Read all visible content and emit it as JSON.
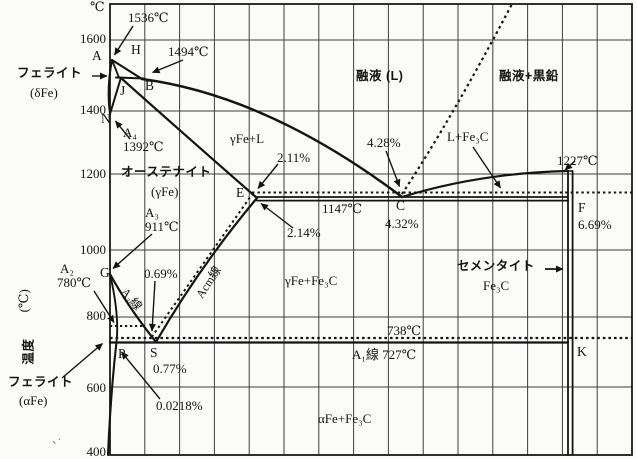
{
  "y_axis": {
    "unit_top": "℃",
    "title_vertical": "温度",
    "title_unit": "(℃)",
    "ticks": [
      "1600",
      "1400",
      "1200",
      "1000",
      "800",
      "600",
      "400"
    ]
  },
  "points": {
    "A": "A",
    "H": "H",
    "B": "B",
    "J": "J",
    "N": "N",
    "E": "E",
    "C": "C",
    "F": "F",
    "G": "G",
    "P": "P",
    "S": "S",
    "K": "K"
  },
  "regions": {
    "ferrite_delta_1": "フェライト",
    "ferrite_delta_2": "(δFe)",
    "austenite_1": "オーステナイト",
    "austenite_2": "(γFe)",
    "liquid": "融液 (L)",
    "liquid_graphite": "融液+黒鉛",
    "gamma_plus_l": "γFe+L",
    "l_plus_fe3c": "L+Fe₃C",
    "gamma_plus_fe3c": "γFe+Fe₃C",
    "cementite_1": "セメンタイト",
    "cementite_2": "Fe₃C",
    "alpha_plus_fe3c": "αFe+Fe₃C",
    "ferrite_alpha_1": "フェライト",
    "ferrite_alpha_2": "(αFe)"
  },
  "annotations": {
    "t1536": "1536℃",
    "t1494": "1494℃",
    "a4": "A₄",
    "t1392": "1392℃",
    "a3": "A₃",
    "t911": "911℃",
    "a2": "A₂",
    "t780": "780℃",
    "t1147": "1147℃",
    "t1227": "1227℃",
    "t738": "738℃",
    "a1_727": "A₁線 727℃",
    "a3_line": "A₃線",
    "acm_line": "Acm線",
    "p211": "2.11%",
    "p214": "2.14%",
    "p428": "4.28%",
    "p432": "4.32%",
    "p069": "0.69%",
    "p077": "0.77%",
    "p00218": "0.0218%",
    "p669": "6.69%"
  },
  "stray_marks": "、·",
  "chart_data": {
    "type": "line",
    "description": "Iron–carbon (Fe-C) equilibrium phase diagram, temperature vs carbon content; solid lines Fe-Fe3C system, dotted lines Fe-graphite system",
    "y_axis": {
      "label": "温度 (℃)",
      "range": [
        400,
        1600
      ],
      "ticks": [
        1600,
        1400,
        1200,
        1000,
        800,
        600,
        400
      ]
    },
    "x_axis": {
      "label": "",
      "ticks": []
    },
    "points": [
      {
        "label": "A",
        "temp_c": 1536,
        "carbon_pct": 0
      },
      {
        "label": "H",
        "temp_c": 1494
      },
      {
        "label": "B",
        "temp_c": 1494
      },
      {
        "label": "J",
        "temp_c": 1494
      },
      {
        "label": "N",
        "temp_c": 1392,
        "carbon_pct": 0
      },
      {
        "label": "E",
        "temp_c": 1147,
        "carbon_pct": 2.14
      },
      {
        "label": "C",
        "temp_c": 1147,
        "carbon_pct": 4.32
      },
      {
        "label": "F",
        "temp_c": 1147,
        "carbon_pct": 6.69
      },
      {
        "label": "G",
        "temp_c": 911,
        "carbon_pct": 0
      },
      {
        "label": "P",
        "temp_c": 727,
        "carbon_pct": 0.0218
      },
      {
        "label": "S",
        "temp_c": 727,
        "carbon_pct": 0.77
      },
      {
        "label": "K",
        "temp_c": 727,
        "carbon_pct": 6.69
      }
    ],
    "isotherms": [
      {
        "temp_c": 1494,
        "style": "solid"
      },
      {
        "temp_c": 1227,
        "style": "solid",
        "label": "1227℃"
      },
      {
        "temp_c": 1147,
        "style": "solid",
        "label": "1147℃"
      },
      {
        "temp_c": 738,
        "style": "dotted",
        "label": "738℃"
      },
      {
        "temp_c": 727,
        "style": "solid",
        "label": "A₁線 727℃"
      }
    ],
    "stable_graphite_system": {
      "eutectic_pct": 4.28,
      "austenite_max_solubility_pct": 2.11,
      "eutectoid_pct": 0.69,
      "eutectoid_temp_c": 738
    },
    "metastable_fe3c_system": {
      "eutectic_pct": 4.32,
      "austenite_max_solubility_pct": 2.14,
      "eutectoid_pct": 0.77,
      "alpha_max_solubility_pct": 0.0218,
      "cementite_pct": 6.69
    },
    "transformation_points": {
      "A₁": 727,
      "A₂": 780,
      "A₃": 911,
      "A₄": 1392,
      "melting": 1536,
      "peritectic": 1494
    },
    "boundary_lines": [
      "A₁線",
      "A₃線",
      "Acm線"
    ],
    "regions": [
      "フェライト(δFe)",
      "融液 (L)",
      "融液+黒鉛",
      "γFe+L",
      "L+Fe₃C",
      "オーステナイト(γFe)",
      "γFe+Fe₃C",
      "セメンタイト Fe₃C",
      "αFe+Fe₃C",
      "フェライト(αFe)"
    ],
    "grid": true,
    "legend": false
  }
}
